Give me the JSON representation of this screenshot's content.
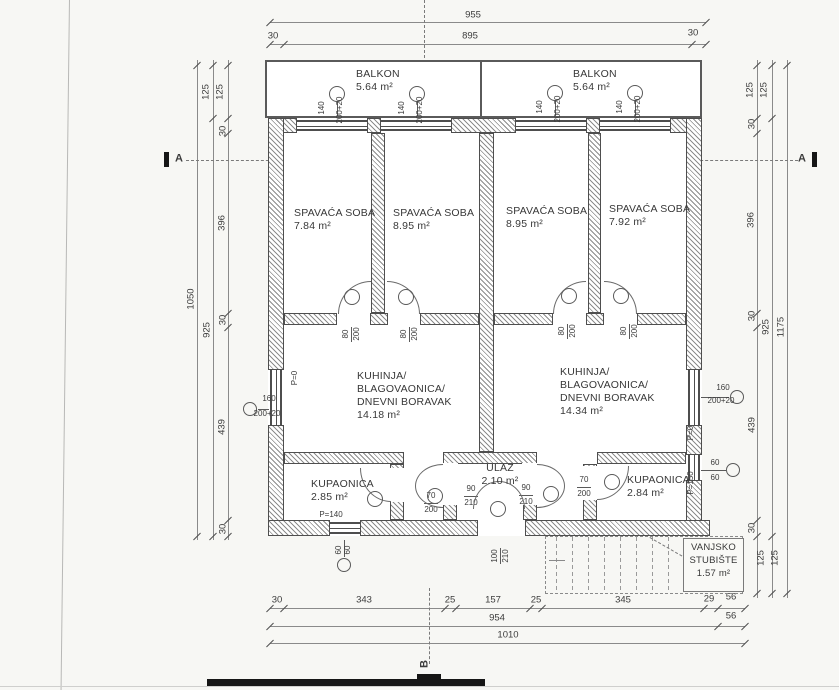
{
  "rooms": {
    "balkon_left": {
      "name": "BALKON",
      "area": "5.64 m²"
    },
    "balkon_right": {
      "name": "BALKON",
      "area": "5.64 m²"
    },
    "bedroom1": {
      "name": "SPAVAĆA SOBA",
      "area": "7.84 m²"
    },
    "bedroom2": {
      "name": "SPAVAĆA SOBA",
      "area": "8.95 m²"
    },
    "bedroom3": {
      "name": "SPAVAĆA SOBA",
      "area": "8.95 m²"
    },
    "bedroom4": {
      "name": "SPAVAĆA SOBA",
      "area": "7.92 m²"
    },
    "living_left": {
      "name_line1": "KUHINJA/",
      "name_line2": "BLAGOVAONICA/",
      "name_line3": "DNEVNI BORAVAK",
      "area": "14.18 m²"
    },
    "living_right": {
      "name_line1": "KUHINJA/",
      "name_line2": "BLAGOVAONICA/",
      "name_line3": "DNEVNI BORAVAK",
      "area": "14.34 m²"
    },
    "bath_left": {
      "name": "KUPAONICA",
      "area": "2.85 m²"
    },
    "bath_right": {
      "name": "KUPAONICA",
      "area": "2.84 m²"
    },
    "ulaz": {
      "name": "ULAZ",
      "area": "2.10 m²"
    },
    "stairs": {
      "name_line1": "VANJSKO",
      "name_line2": "STUBIŠTE",
      "area": "1.57 m²"
    }
  },
  "dims": {
    "top": {
      "overall": "955",
      "margin_left": "30",
      "inner": "895",
      "margin_right": "30"
    },
    "side": {
      "balcony_depth": "125",
      "wall": "30",
      "bedroom_depth": "396",
      "living_depth": "439",
      "body": "925",
      "left_overall": "1050",
      "right_overall": "1175",
      "stair_depth": "125"
    },
    "bottom": {
      "margin": "30",
      "seg1": "343",
      "gap1": "25",
      "seg2": "157",
      "gap2": "25",
      "seg3": "345",
      "seg4": "29",
      "seg5": "56",
      "subtotal": "954",
      "edge": "56",
      "total": "1010"
    }
  },
  "openings": {
    "balcony_window": {
      "w": "140",
      "h": "200+20"
    },
    "side_window": {
      "w": "160",
      "h": "200+20"
    },
    "small_window": {
      "w": "60",
      "h": "60"
    },
    "bedroom_door": {
      "w": "80",
      "h": "200"
    },
    "bath_door": {
      "w": "70",
      "h": "200"
    },
    "hall_door": {
      "w": "90",
      "h": "210"
    },
    "entry_door": {
      "w": "100",
      "h": "210"
    },
    "parapet_zero": "P=0",
    "parapet_140": "P=140",
    "parapet_150": "P=150"
  },
  "sections": {
    "a": "A",
    "b": "B"
  }
}
